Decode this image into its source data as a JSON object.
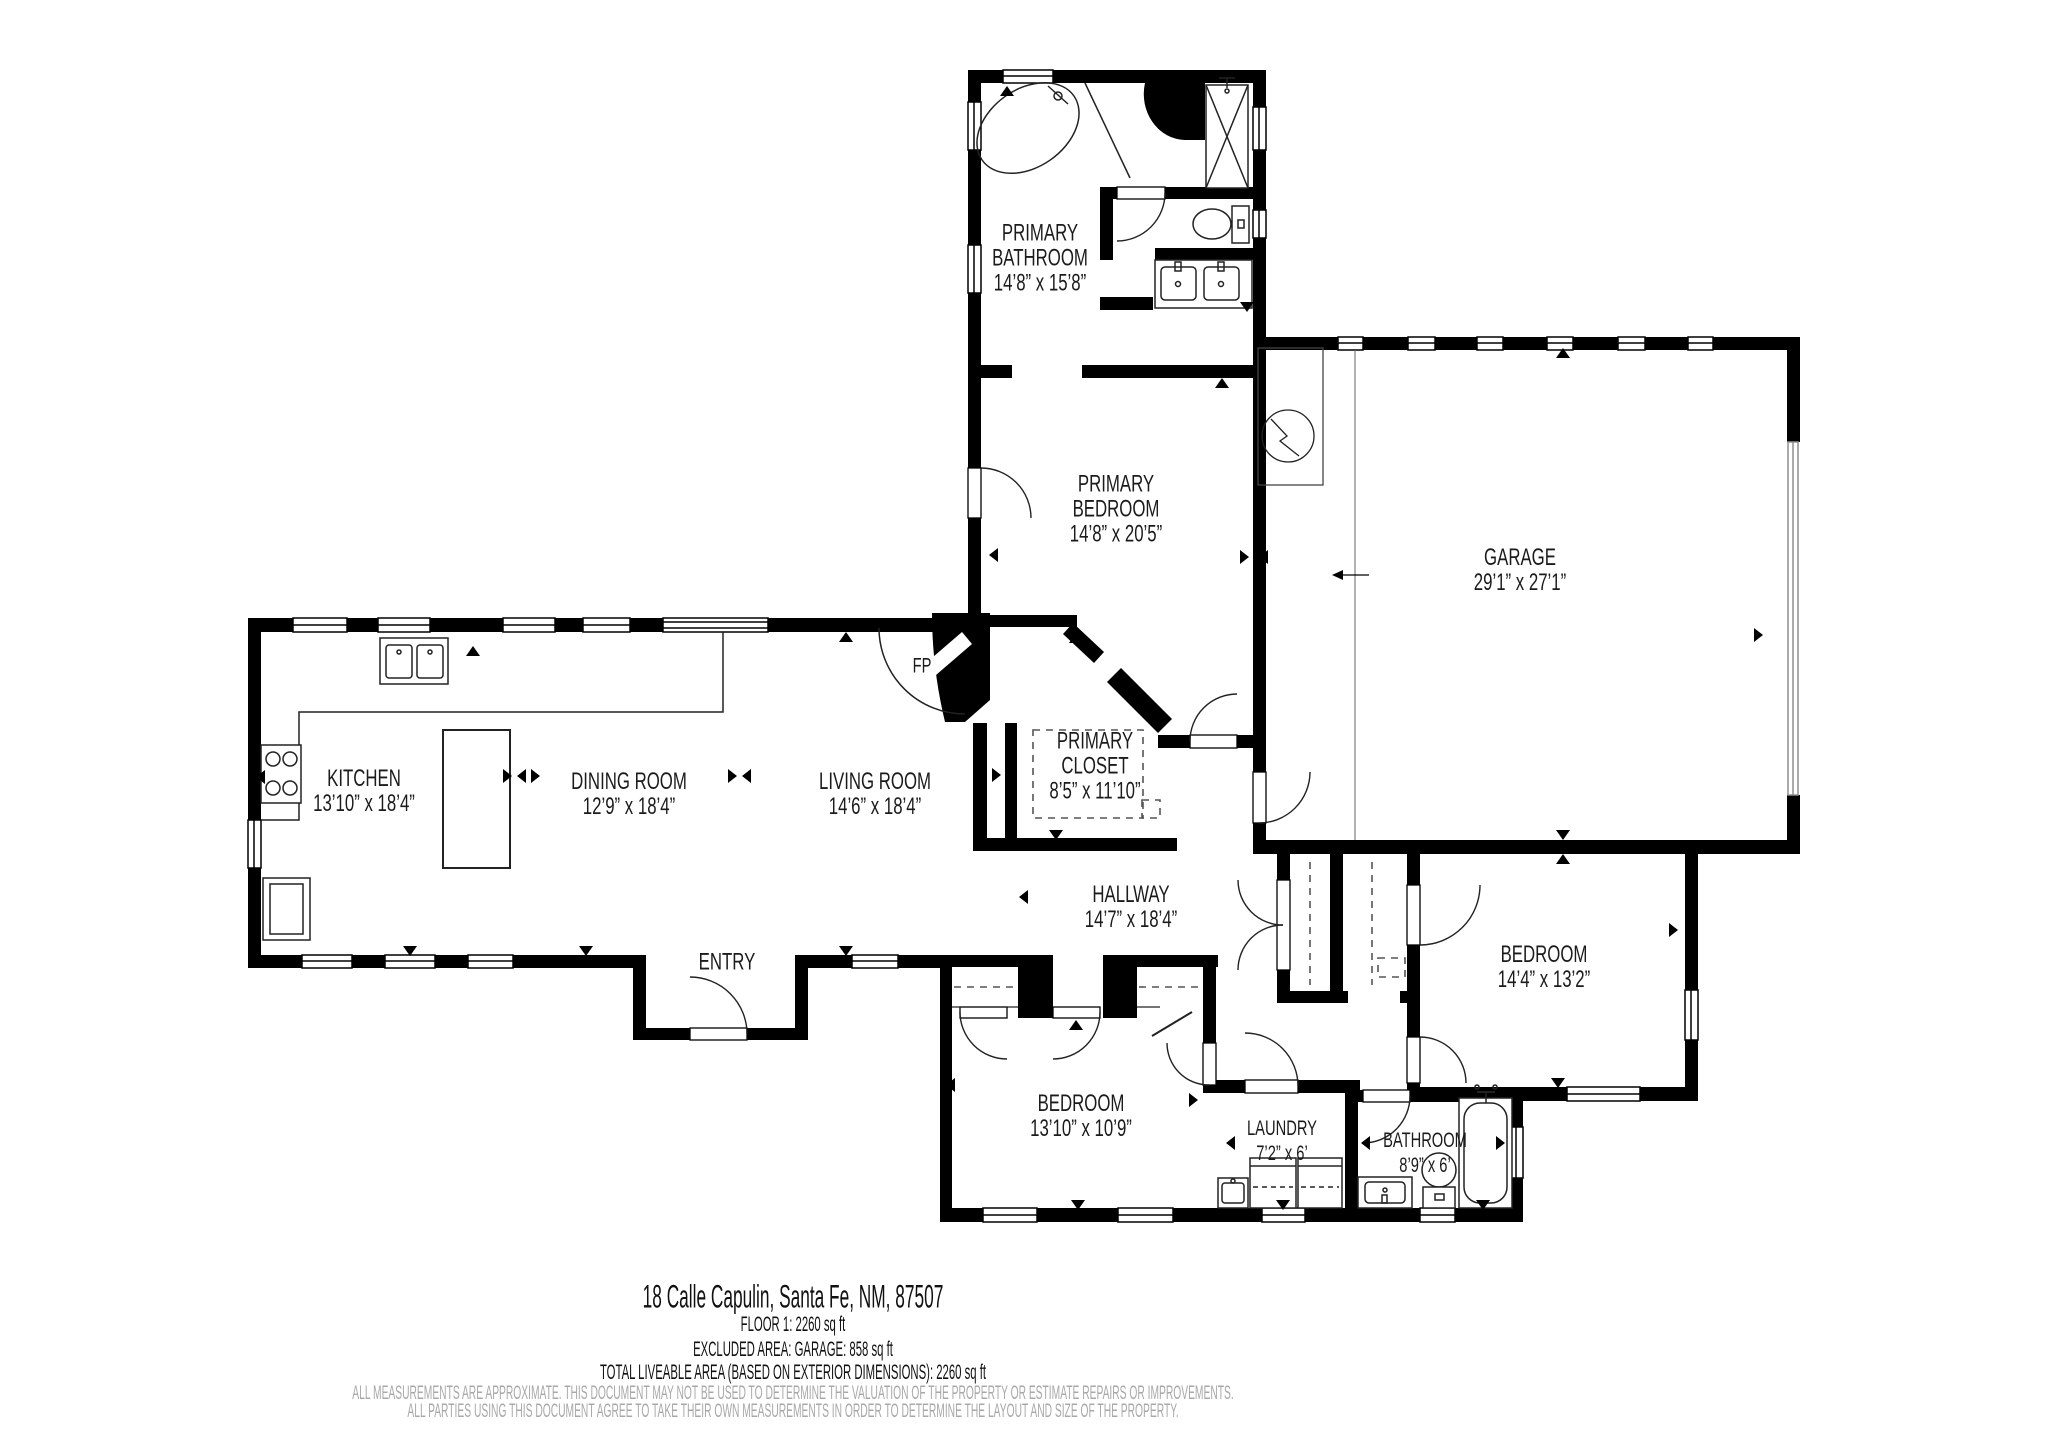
{
  "rooms": {
    "primary_bathroom": {
      "lines": [
        "PRIMARY",
        "BATHROOM",
        "14’8” x 15’8”"
      ]
    },
    "primary_bedroom": {
      "lines": [
        "PRIMARY",
        "BEDROOM",
        "14’8” x 20’5”"
      ]
    },
    "garage": {
      "lines": [
        "GARAGE",
        "29’1” x 27’1”"
      ]
    },
    "kitchen": {
      "lines": [
        "KITCHEN",
        "13’10” x 18’4”"
      ]
    },
    "dining_room": {
      "lines": [
        "DINING ROOM",
        "12’9” x 18’4”"
      ]
    },
    "living_room": {
      "lines": [
        "LIVING ROOM",
        "14’6” x 18’4”"
      ]
    },
    "primary_closet": {
      "lines": [
        "PRIMARY",
        "CLOSET",
        "8’5” x 11’10”"
      ]
    },
    "hallway": {
      "lines": [
        "HALLWAY",
        "14’7” x 18’4”"
      ]
    },
    "entry": {
      "lines": [
        "ENTRY"
      ]
    },
    "bedroom_south": {
      "lines": [
        "BEDROOM",
        "13’10” x 10’9”"
      ]
    },
    "bedroom_east": {
      "lines": [
        "BEDROOM",
        "14’4” x 13’2”"
      ]
    },
    "laundry": {
      "lines": [
        "LAUNDRY",
        "7’2” x 6’"
      ]
    },
    "bathroom": {
      "lines": [
        "BATHROOM",
        "8’9” x 6’"
      ]
    },
    "fireplace": {
      "lines": [
        "FP"
      ]
    }
  },
  "footer": {
    "address": "18 Calle Capulin, Santa Fe, NM, 87507",
    "floor_area": "FLOOR 1: 2260 sq ft",
    "excluded_area": "EXCLUDED AREA: GARAGE: 858 sq ft",
    "total_area": "TOTAL LIVEABLE AREA (BASED ON EXTERIOR DIMENSIONS): 2260 sq ft",
    "disclaimer_line1": "ALL MEASUREMENTS ARE APPROXIMATE. THIS DOCUMENT MAY NOT BE USED TO DETERMINE THE VALUATION OF THE PROPERTY OR ESTIMATE REPAIRS OR IMPROVEMENTS.",
    "disclaimer_line2": "ALL PARTIES USING THIS DOCUMENT AGREE TO TAKE THEIR OWN MEASUREMENTS IN ORDER TO DETERMINE THE LAYOUT AND SIZE OF THE PROPERTY."
  },
  "colors": {
    "wall": "#000000",
    "background": "#ffffff",
    "disclaimer": "#a8a8a8",
    "garage_door": "#8f8f8f"
  }
}
